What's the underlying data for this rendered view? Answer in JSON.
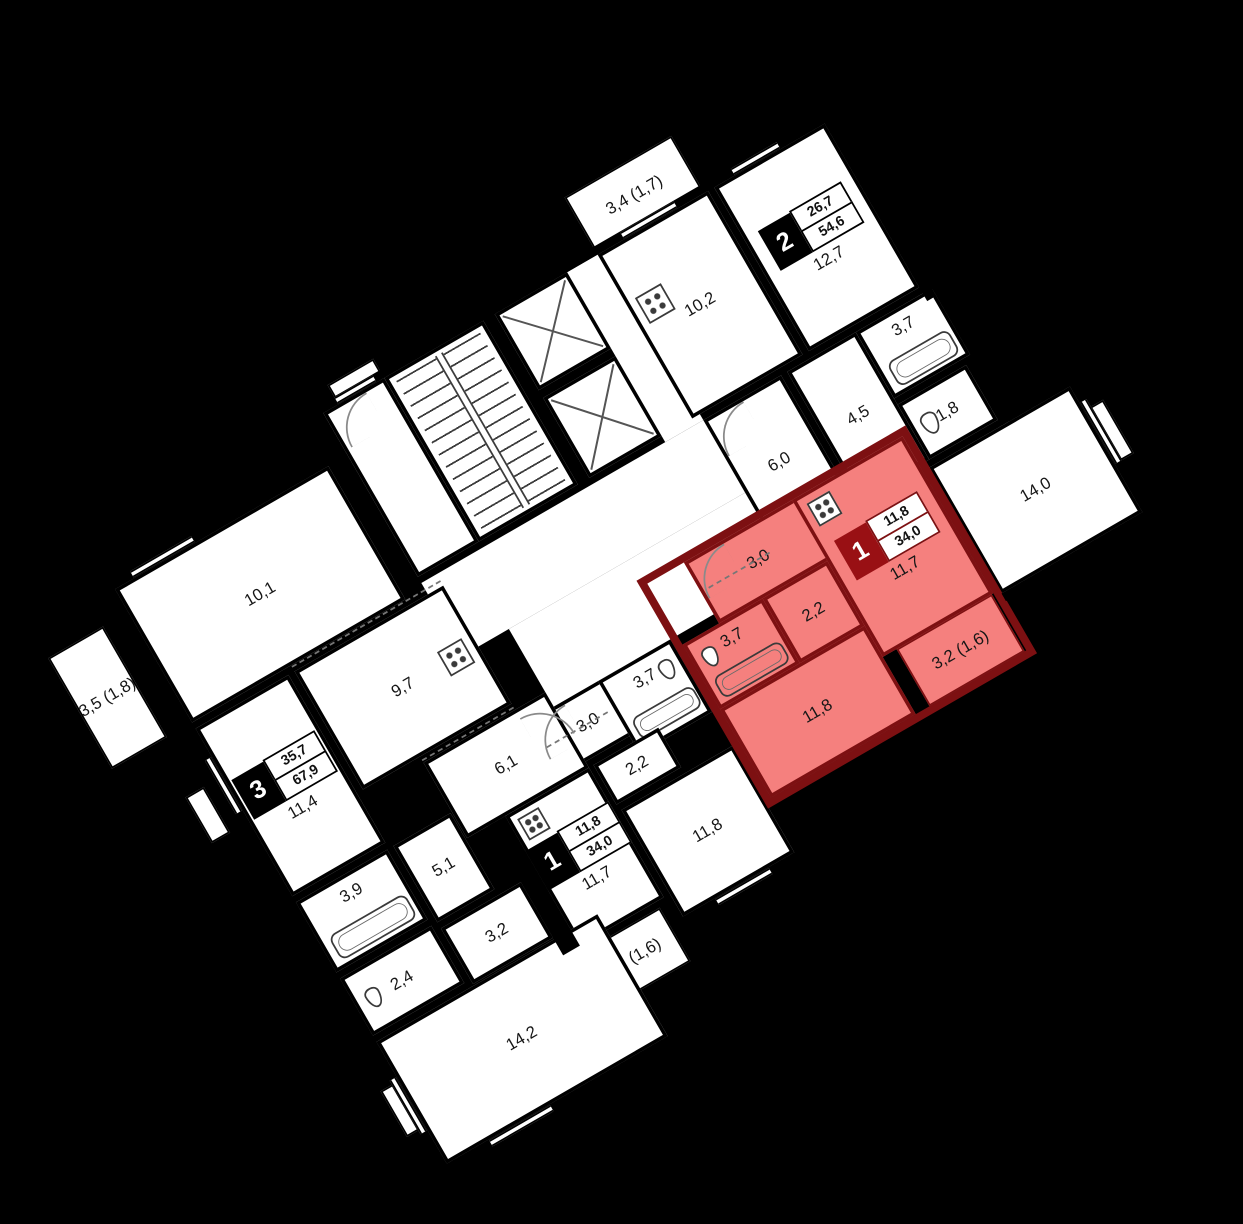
{
  "colors": {
    "background": "#000000",
    "floor": "#ffffff",
    "wall": "#000000",
    "highlight_fill": "#f5807e",
    "highlight_wall": "#7d1012",
    "highlight_label_bg": "#991014"
  },
  "apartments": {
    "apt2": {
      "num": "2",
      "living": "26,7",
      "total": "54,6"
    },
    "apt3": {
      "num": "3",
      "living": "35,7",
      "total": "67,9"
    },
    "apt1_highlight": {
      "num": "1",
      "living": "11,8",
      "total": "34,0"
    },
    "apt1_lower": {
      "num": "1",
      "living": "11,8",
      "total": "34,0"
    }
  },
  "rooms": {
    "apt2_balcony": "3,4 (1,7)",
    "apt2_kitchen": "10,2",
    "apt2_room1": "12,7",
    "apt2_corridor": "6,0",
    "apt2_hall": "4,5",
    "apt2_bath": "3,7",
    "apt2_wc": "1,8",
    "apt2_room2": "14,0",
    "red_hall": "3,0",
    "red_bath": "3,7",
    "red_corr": "2,2",
    "red_kitchen": "11,7",
    "red_living": "11,8",
    "red_balcony": "3,2 (1,6)",
    "low_hall": "3,0",
    "low_bath": "3,7",
    "low_corr": "2,2",
    "low_kitchen": "11,7",
    "low_living": "11,8",
    "low_balcony": "3,2 (1,6)",
    "apt3_room1": "10,1",
    "apt3_kitchen": "9,7",
    "apt3_room2": "11,4",
    "apt3_balcony": "3,5 (1,8)",
    "apt3_corridor": "6,1",
    "apt3_hall": "5,1",
    "apt3_bath": "3,9",
    "apt3_wc": "2,4",
    "apt3_storage": "3,2",
    "apt3_room3": "14,2"
  }
}
